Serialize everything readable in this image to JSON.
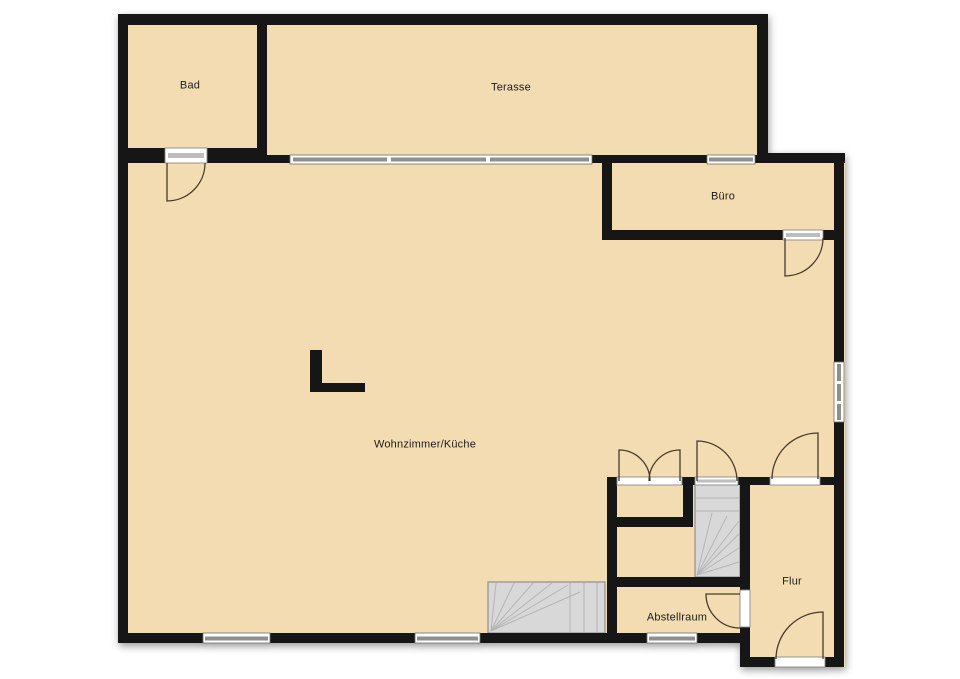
{
  "floorplan": {
    "rooms": {
      "bad": {
        "label": "Bad"
      },
      "terasse": {
        "label": "Terasse"
      },
      "buero": {
        "label": "Büro"
      },
      "wohnzimmer_kueche": {
        "label": "Wohnzimmer/Küche"
      },
      "abstellraum": {
        "label": "Abstellraum"
      },
      "flur": {
        "label": "Flur"
      }
    },
    "colors": {
      "floor": "#f3dcb2",
      "wall": "#141414",
      "background": "#ffffff",
      "stair_fill": "#d8d8d8",
      "stair_line": "#b5b5b5",
      "window_band": "#8f8f8f",
      "door_arc": "#4a3b2c",
      "label_text": "#1c1c1c"
    }
  }
}
